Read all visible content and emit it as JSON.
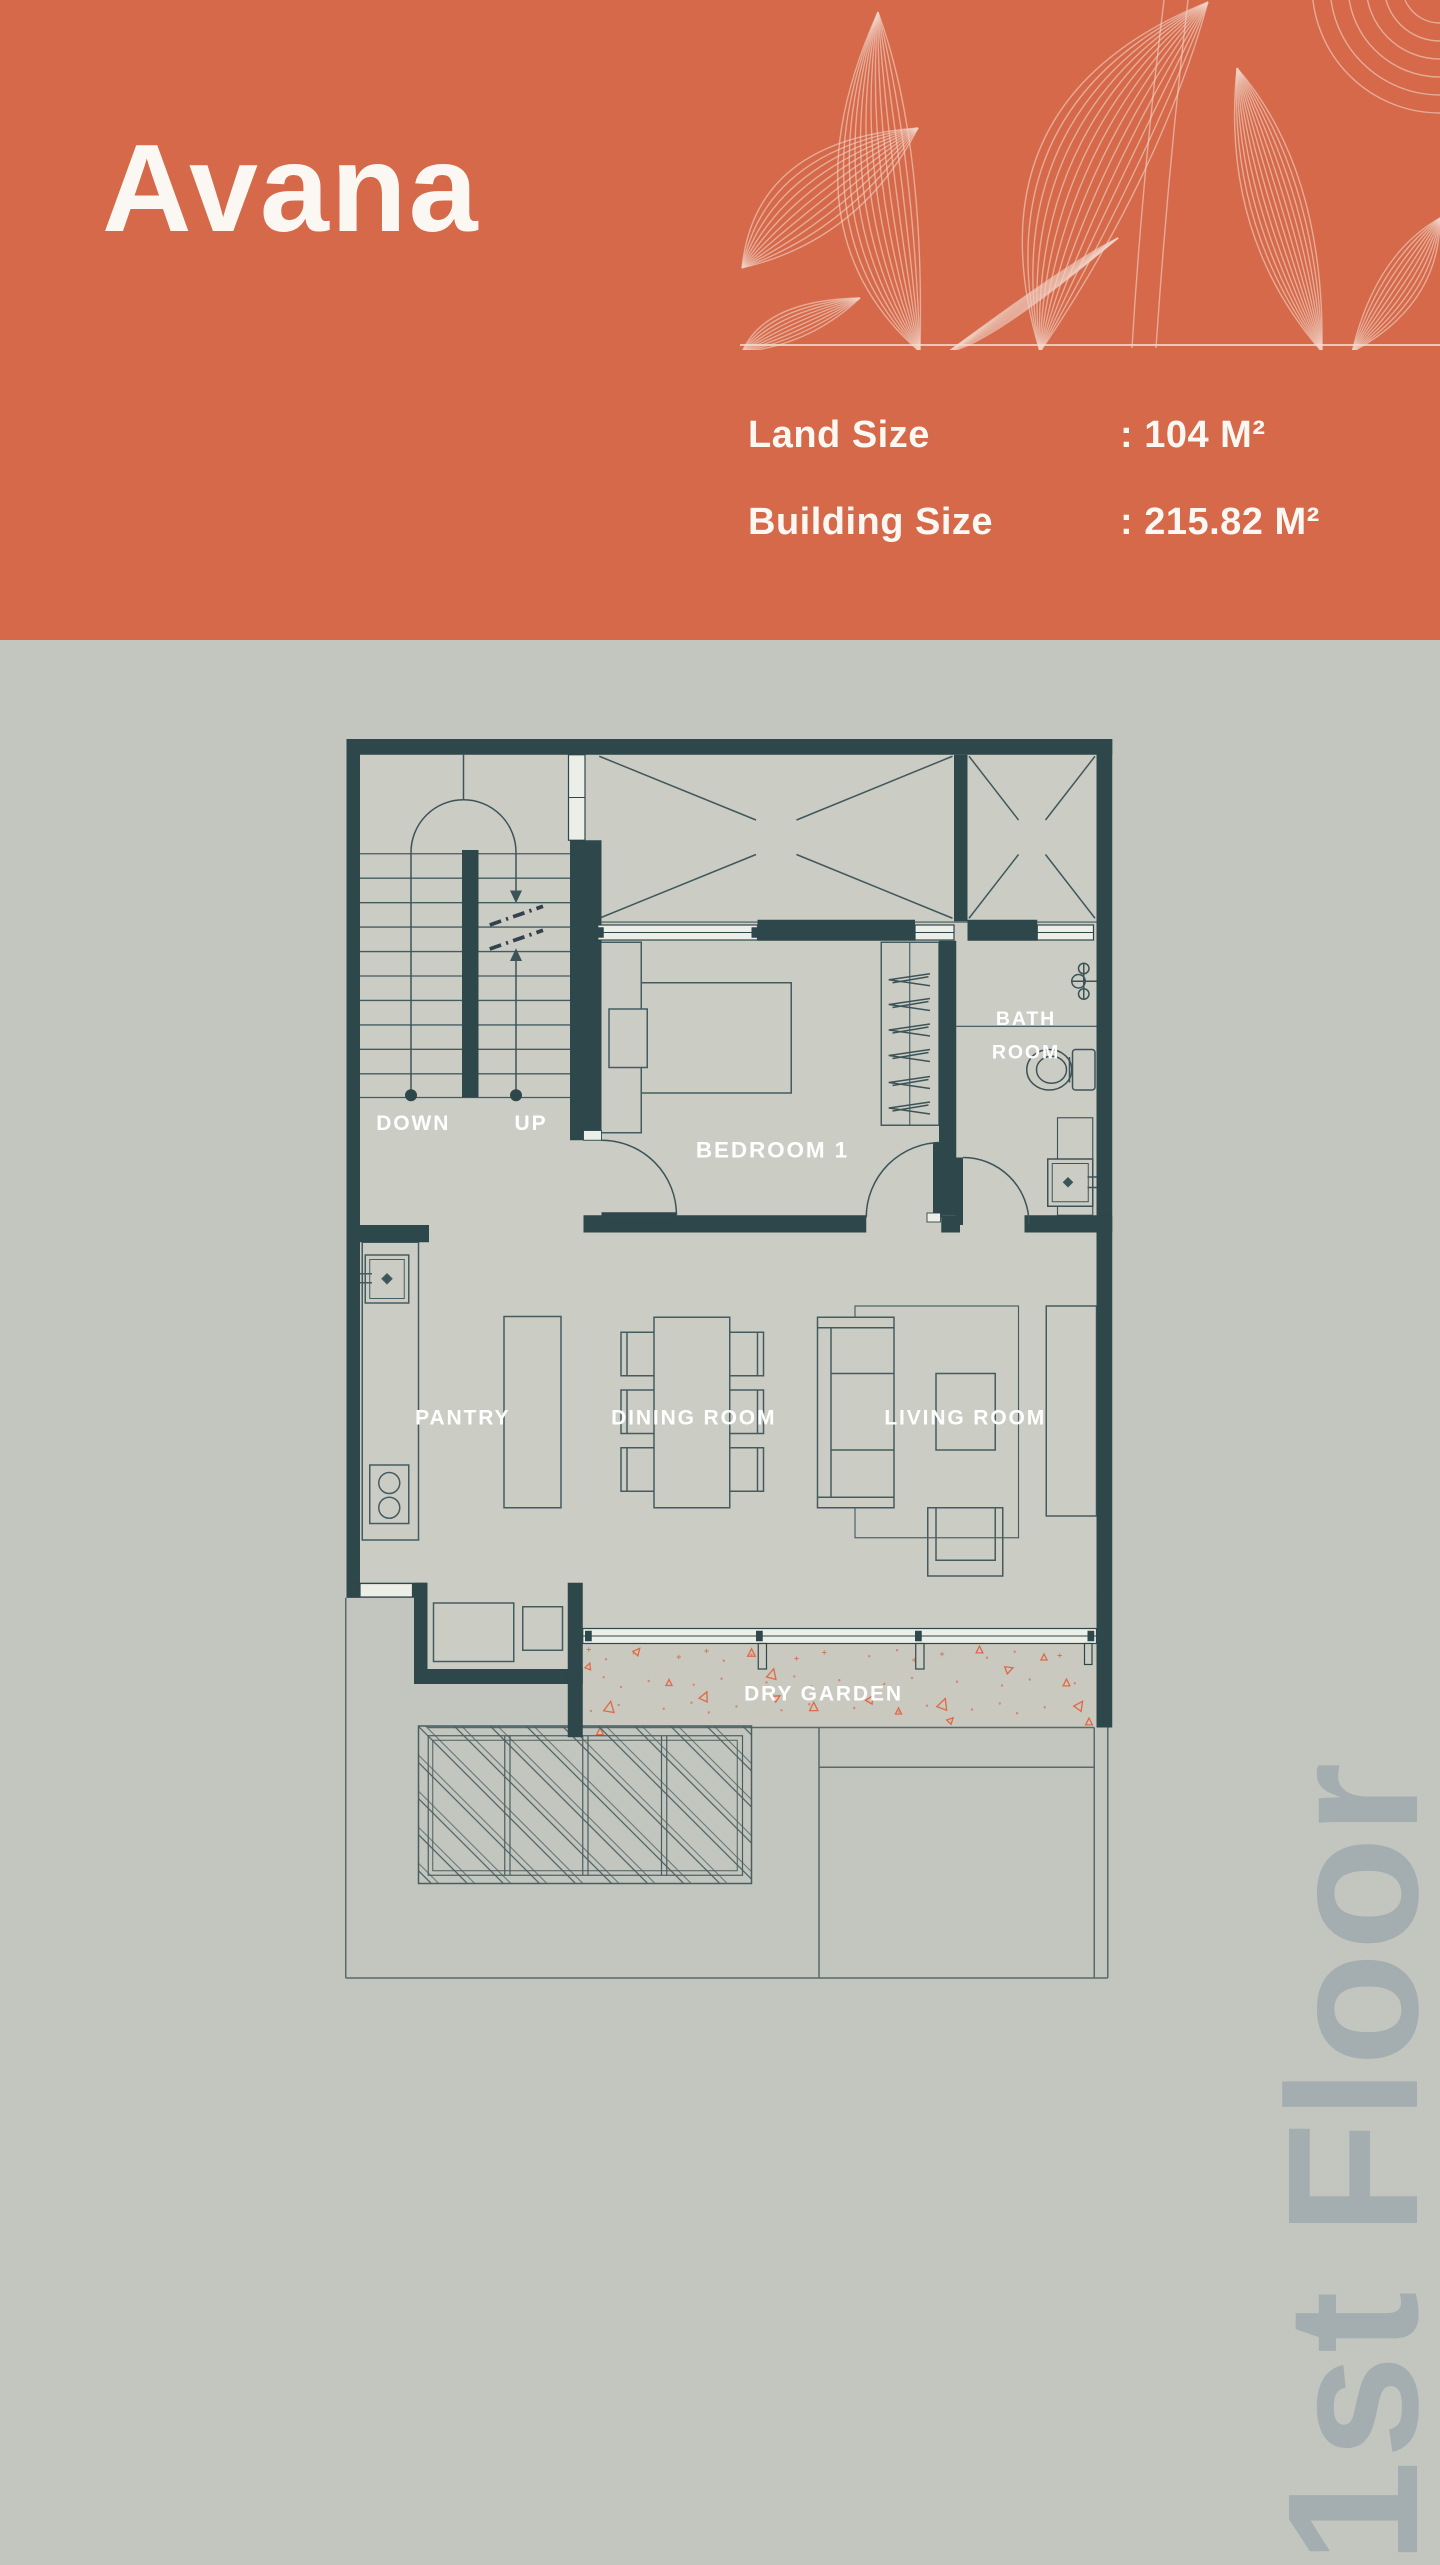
{
  "header": {
    "title": "Avana",
    "land_size_label": "Land Size",
    "land_size_value": ": 104 M²",
    "building_size_label": "Building Size",
    "building_size_value": ": 215.82 M²"
  },
  "floor_plan": {
    "floor_label": "1st Floor",
    "rooms": {
      "bedroom": "BEDROOM 1",
      "bathroom_line1": "BATH",
      "bathroom_line2": "ROOM",
      "pantry": "PANTRY",
      "dining": "DINING ROOM",
      "living": "LIVING ROOM",
      "dry_garden": "DRY GARDEN",
      "stairs_down": "DOWN",
      "stairs_up": "UP"
    }
  },
  "colors": {
    "header_background": "#d5694a",
    "page_background": "#c3c6bf",
    "floor_fill": "#cbccc4",
    "wall": "#2e474b",
    "drawing_line": "#445c60",
    "accent_triangle": "#e06a48",
    "floor_label_text": "#a4aeb1",
    "label_text": "#ffffff"
  }
}
